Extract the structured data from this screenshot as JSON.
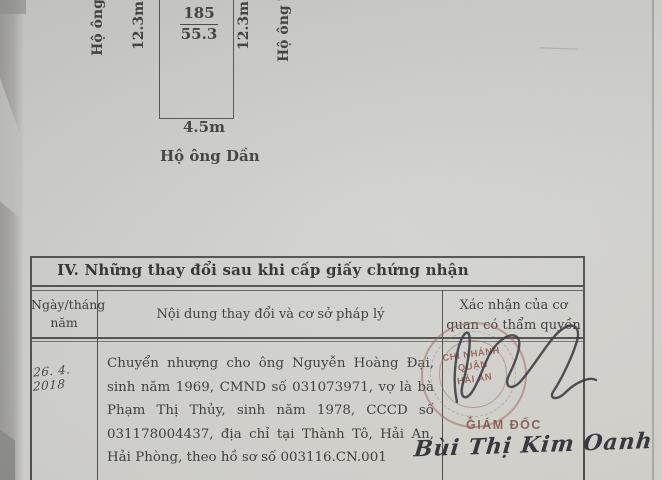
{
  "diagram": {
    "plot_number": "185",
    "plot_area": "55.3",
    "dim_left": "12.3m",
    "dim_right": "12.3m",
    "dim_bottom": "4.5m",
    "neighbor_left": "Hộ ông Đ",
    "neighbor_right": "Hộ ông T",
    "neighbor_bottom": "Hộ ông Dần"
  },
  "table": {
    "section_title": "IV. Những thay đổi sau khi cấp giấy chứng nhận",
    "col_date": "Ngày/tháng năm",
    "col_content": "Nội dung thay đổi và cơ sở pháp lý",
    "col_confirm": "Xác nhận của cơ quan có thẩm quyền",
    "row": {
      "date": "26. 4. 2018",
      "content": "Chuyển nhượng cho ông Nguyễn Hoàng Đại, sinh năm 1969, CMND số 031073971, vợ là bà Phạm Thị Thủy, sinh năm 1978, CCCD số 031178004437, địa chỉ tại Thành Tô, Hải An, Hải Phòng, theo hồ sơ số 003116.CN.001",
      "stamp_line1": "CHI NHÁNH",
      "stamp_line2": "QUẬN",
      "stamp_line3": "HẢI AN",
      "signer_title": "GIÁM ĐỐC",
      "signer_name": "Bùi Thị Kim Oanh"
    }
  },
  "colors": {
    "paper": "#d0d0cc",
    "ink": "#3c3c3a",
    "table_line": "#4e4e4a",
    "stamp_red": "#9a6f66",
    "signature_ink": "#33333a"
  }
}
